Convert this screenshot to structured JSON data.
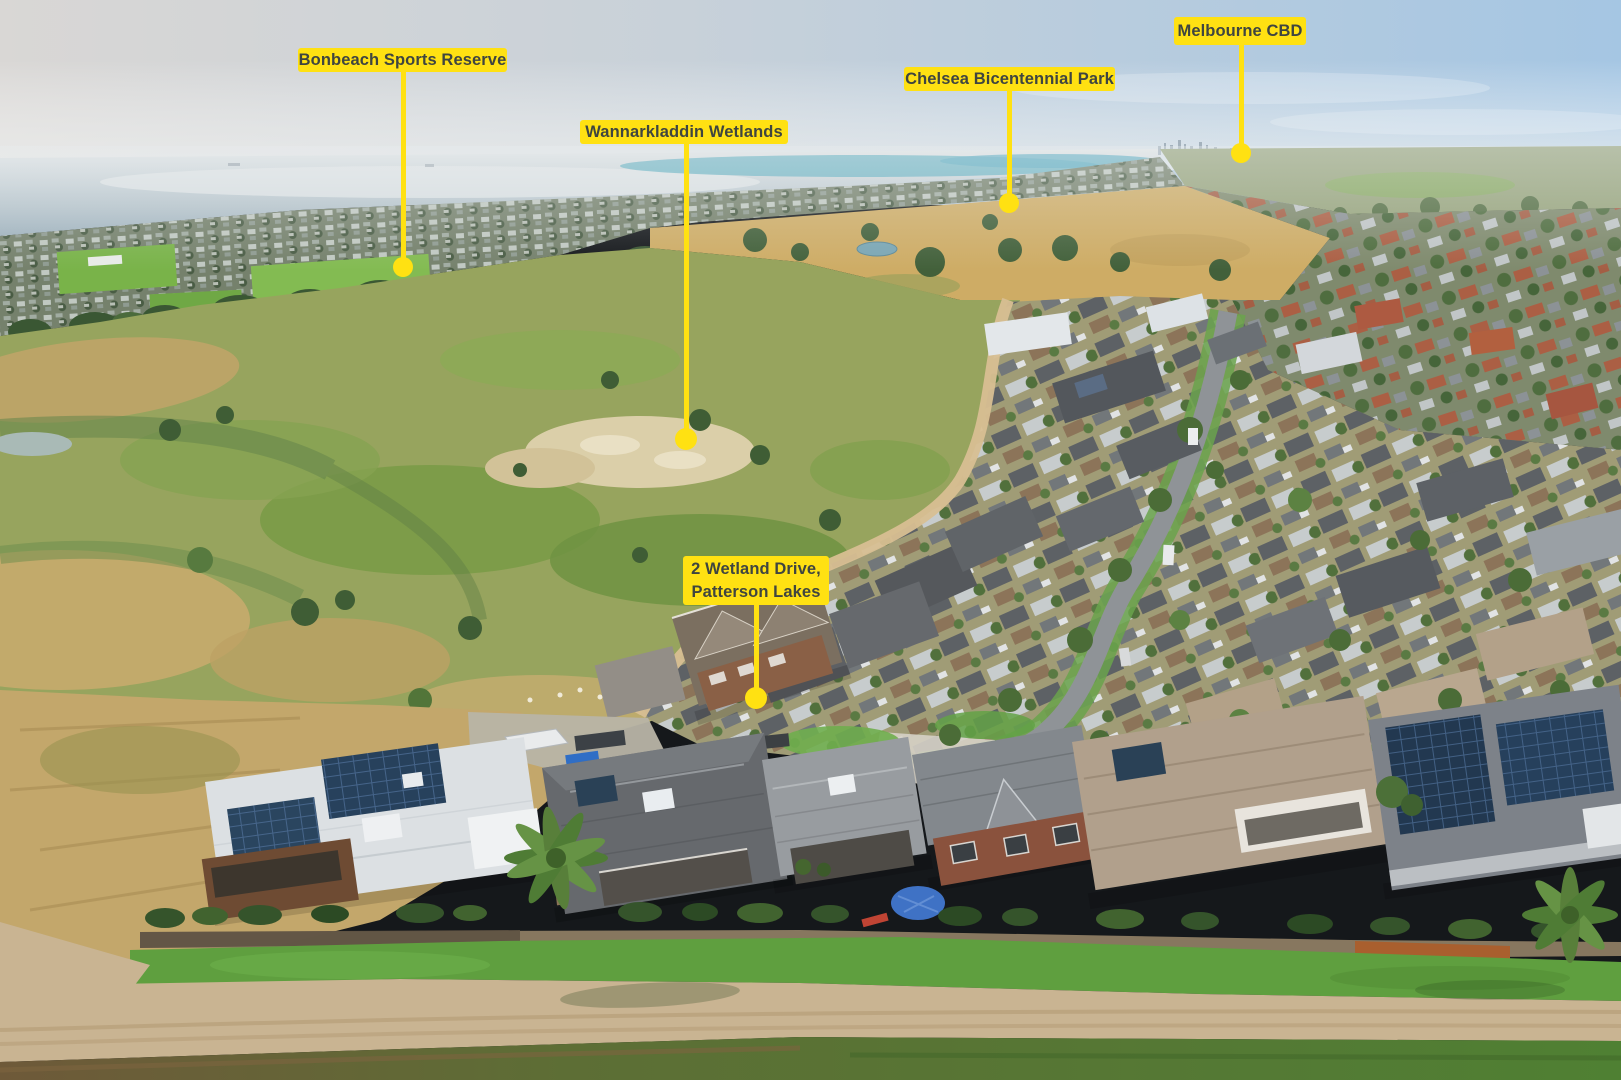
{
  "scene": {
    "description": "Aerial drone photo looking across Wannarkladdin Wetlands and a Patterson Lakes housing estate toward Port Phillip Bay, with yellow location callouts"
  },
  "colors": {
    "label_bg": "#FFE112",
    "label_text": "#3F4540",
    "pointer": "#FFE112"
  },
  "callouts": [
    {
      "id": "bonbeach-sports-reserve",
      "lines": [
        "Bonbeach Sports Reserve"
      ],
      "box": {
        "x": 298,
        "y": 48,
        "w": 209,
        "h": 24
      },
      "anchor": {
        "x": 403,
        "y": 267
      },
      "dot_r": 10
    },
    {
      "id": "wannarkladdin-wetlands",
      "lines": [
        "Wannarkladdin Wetlands"
      ],
      "box": {
        "x": 580,
        "y": 120,
        "w": 208,
        "h": 24
      },
      "anchor": {
        "x": 686,
        "y": 439
      },
      "dot_r": 11
    },
    {
      "id": "chelsea-bicentennial-park",
      "lines": [
        "Chelsea Bicentennial Park"
      ],
      "box": {
        "x": 904,
        "y": 67,
        "w": 211,
        "h": 24
      },
      "anchor": {
        "x": 1009,
        "y": 203
      },
      "dot_r": 10
    },
    {
      "id": "melbourne-cbd",
      "lines": [
        "Melbourne CBD"
      ],
      "box": {
        "x": 1174,
        "y": 17,
        "w": 132,
        "h": 28
      },
      "anchor": {
        "x": 1241,
        "y": 153
      },
      "dot_r": 10
    },
    {
      "id": "property-address",
      "lines": [
        "2 Wetland Drive,",
        "Patterson Lakes"
      ],
      "box": {
        "x": 683,
        "y": 556,
        "w": 146,
        "h": 49
      },
      "anchor": {
        "x": 756,
        "y": 698
      },
      "dot_r": 11
    }
  ]
}
